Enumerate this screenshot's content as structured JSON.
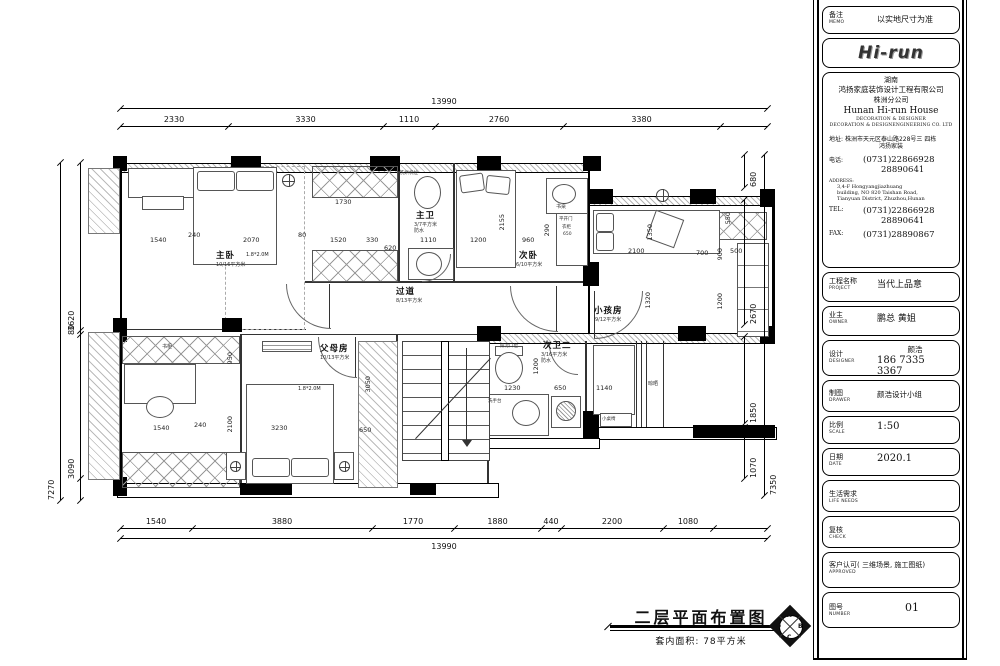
{
  "sheet": {
    "memo": {
      "cn": "备注",
      "en": "MEMO",
      "value": "以实地尺寸为准"
    },
    "logo_text": "Hi-run",
    "company": {
      "region": "湖南",
      "name_cn": "鸿扬家庭装饰设计工程有限公司",
      "branch_cn": "株洲分公司",
      "name_en": "Hunan  Hi-run  House",
      "sub_en1": "DECORATION  &  DESIGNER",
      "sub_en2": "DECORATION & DESIGNENGINEERING CO. LTD",
      "addr_cn_label": "地址:",
      "addr_cn1": "株洲市天元区泰山路228号三 四栋",
      "addr_cn2": "鸿扬家装",
      "tel_cn_label": "电话:",
      "tel1": "(0731)22866928",
      "tel2": "28890641",
      "address_en_label": "ADDRESS:",
      "address_en1": "3,4-F Hongyangjiazhuang",
      "address_en2": "building, NO 820 Taishan Road,",
      "address_en3": "Tianyuan District, Zhuzhou,Hunan",
      "tel_en_label": "TEL:",
      "fax_label": "FAX:",
      "fax": "(0731)28890867"
    },
    "fields": {
      "project": {
        "cn": "工程名称",
        "en": "PROJECT",
        "value": "当代上品意"
      },
      "owner": {
        "cn": "业主",
        "en": "OWNER",
        "value": "鹏总  黄姐"
      },
      "designer": {
        "cn": "设计",
        "en": "DESIGNER",
        "name": "颜浩",
        "phone": "186  7335  3367"
      },
      "drawer": {
        "cn": "制图",
        "en": "DRAWER",
        "value": "颜浩设计小组"
      },
      "scale": {
        "cn": "比例",
        "en": "SCALE",
        "value": "1:50"
      },
      "date": {
        "cn": "日期",
        "en": "DATE",
        "value": "2020.1"
      },
      "life": {
        "cn": "生活需求",
        "en": "LIFE  NEEDS",
        "value": ""
      },
      "check": {
        "cn": "复核",
        "en": "CHECK",
        "value": ""
      },
      "approved": {
        "cn": "客户认可( 三维场景, 施工图纸)",
        "en": "APPROVED",
        "value": ""
      },
      "number": {
        "cn": "图号",
        "en": "NUMBER",
        "value": "01"
      }
    }
  },
  "plan": {
    "caption": "二层平面布置图",
    "area_note": "套内面积: 78平方米",
    "compass": {
      "top": "A",
      "right": "B",
      "bottom": "C",
      "left": "D"
    },
    "rooms": {
      "master": {
        "name": "主卧",
        "area": "10/16平方米",
        "bed": "1.8*2.0M"
      },
      "master_bath": {
        "name": "主卫",
        "area": "3/7平方米",
        "note": "防水"
      },
      "second": {
        "name": "次卧",
        "area": "6/10平方米"
      },
      "corridor": {
        "name": "过道",
        "area": "8/13平方米"
      },
      "kids": {
        "name": "小孩房",
        "area": "9/12平方米"
      },
      "parents": {
        "name": "父母房",
        "area": "10/13平方米",
        "bed": "1.8*2.0M"
      },
      "bath2": {
        "name": "次卫二",
        "area": "3/16平方米",
        "note": "防水"
      },
      "labels": {
        "desk": "书桌",
        "bookcase": "书柜",
        "wardrobe1": "平开门",
        "wardrobe2": "衣柜",
        "wardrobe3": "650",
        "dry": "晾晒",
        "table": "小桌椅",
        "basin": "洗手台",
        "washer": "洗烘机位",
        "drain": "排污口位"
      }
    },
    "dims": {
      "top_total": "13990",
      "top": [
        "2330",
        "3330",
        "1110",
        "2760",
        "3380"
      ],
      "bottom": [
        "1540",
        "3880",
        "1770",
        "1880",
        "440",
        "2200",
        "1080"
      ],
      "bottom_total": "13990",
      "left_total": "7270",
      "left": [
        "3620",
        "80",
        "3090"
      ],
      "right": [
        "680",
        "2670",
        "1850",
        "1070"
      ],
      "right_total": "7350",
      "inner": [
        "1540",
        "240",
        "2070",
        "80",
        "1520",
        "330",
        "620",
        "1110",
        "1730",
        "1200",
        "960",
        "2155",
        "290",
        "2100",
        "1350",
        "700",
        "900",
        "550",
        "500",
        "1320",
        "1200",
        "950",
        "1540",
        "240",
        "3230",
        "650",
        "3050",
        "2100",
        "1230",
        "650",
        "1140",
        "1200"
      ]
    }
  }
}
